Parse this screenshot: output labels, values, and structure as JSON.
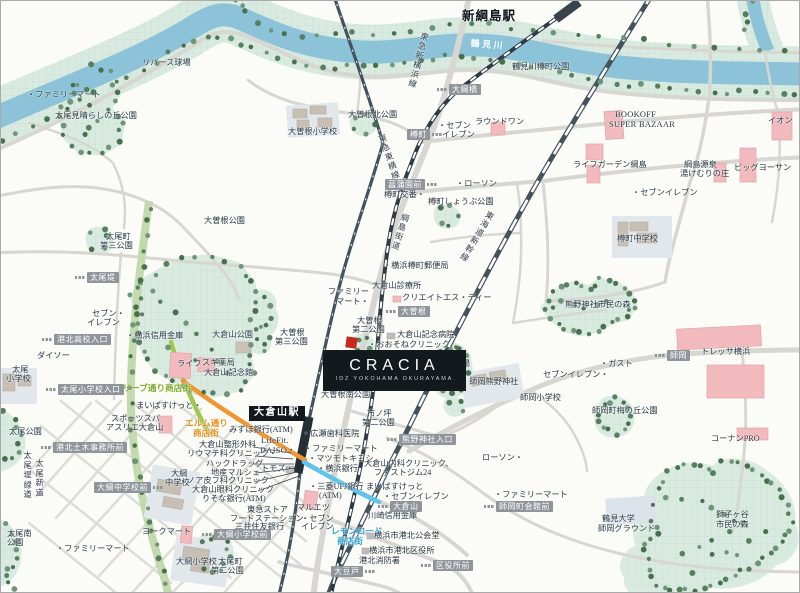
{
  "property": {
    "name": "CRACIA",
    "subtitle": "IDZ YOKOHAMA OKURAYAMA"
  },
  "map": {
    "river_name": "鶴見川",
    "colors": {
      "river": "#8cc3d8",
      "park": "#d9ebe1",
      "road": "#d7d6d1",
      "rail": "#44525c",
      "pink_building": "#f2babd",
      "badge": "#8f959a",
      "olive_street": "#9fc84e",
      "elm_street": "#f0962e",
      "lemon_street": "#5fc4ec",
      "site_marker": "#c8281f"
    },
    "labels": [
      {
        "t": "リバース球場",
        "x": 141,
        "y": 58
      },
      {
        "t": "・ファミリーマート",
        "x": 26,
        "y": 90
      },
      {
        "t": "太尾見晴らしの丘公園",
        "x": 54,
        "y": 111
      },
      {
        "t": "鶴見川",
        "x": 470,
        "y": 38,
        "c": "w",
        "r": 5
      },
      {
        "t": "鶴見川樽町公園",
        "x": 511,
        "y": 62
      },
      {
        "t": "新綱島駅",
        "x": 461,
        "y": 9,
        "c": "st"
      },
      {
        "t": "大曽根北公園",
        "x": 347,
        "y": 110
      },
      {
        "t": "大曽根小学校",
        "x": 287,
        "y": 127
      },
      {
        "t": "・セブン",
        "x": 437,
        "y": 121
      },
      {
        "t": "イレブン",
        "x": 441,
        "y": 130
      },
      {
        "t": "ラウンドワン",
        "x": 474,
        "y": 117
      },
      {
        "t": "BOOKOFF",
        "x": 614,
        "y": 110,
        "c": "en"
      },
      {
        "t": "SUPER BAZAAR",
        "x": 608,
        "y": 120,
        "c": "en"
      },
      {
        "t": "イオン",
        "x": 767,
        "y": 116
      },
      {
        "t": "ライフガーデン綱島",
        "x": 572,
        "y": 160
      },
      {
        "t": "綱島源泉",
        "x": 683,
        "y": 160
      },
      {
        "t": "湯けむりの庄",
        "x": 679,
        "y": 169
      },
      {
        "t": "ビッグヨーサン",
        "x": 733,
        "y": 163
      },
      {
        "t": "・セブンイレブン",
        "x": 631,
        "y": 188
      },
      {
        "t": "・ローソン",
        "x": 455,
        "y": 179
      },
      {
        "t": "樽町交番・",
        "x": 383,
        "y": 190
      },
      {
        "t": "樽町しょうぶ公園",
        "x": 427,
        "y": 197
      },
      {
        "t": "綱島街道",
        "x": 400,
        "y": 211,
        "c": "v",
        "r": 18
      },
      {
        "t": "東急新横浜線",
        "x": 419,
        "y": 30,
        "c": "v",
        "r": 14
      },
      {
        "t": "東急東横線",
        "x": 375,
        "y": 135,
        "c": "v",
        "r": -19
      },
      {
        "t": "東海道新幹線",
        "x": 486,
        "y": 208,
        "c": "v",
        "r": 31
      },
      {
        "t": "・横浜樽町郵便局",
        "x": 382,
        "y": 261
      },
      {
        "t": "大倉山診療所",
        "x": 371,
        "y": 281
      },
      {
        "t": "クリエイトエス・ディー",
        "x": 401,
        "y": 293
      },
      {
        "t": "ファミリー",
        "x": 327,
        "y": 287
      },
      {
        "t": "マート・",
        "x": 335,
        "y": 297
      },
      {
        "t": "大曽根",
        "x": 279,
        "y": 328
      },
      {
        "t": "第三公園",
        "x": 274,
        "y": 337
      },
      {
        "t": "大曽根",
        "x": 356,
        "y": 316
      },
      {
        "t": "第二公園",
        "x": 351,
        "y": 325
      },
      {
        "t": "大倉山記念病院",
        "x": 396,
        "y": 330
      },
      {
        "t": "・おおそねクリニック",
        "x": 367,
        "y": 340
      },
      {
        "t": "権現山広場",
        "x": 428,
        "y": 359
      },
      {
        "t": "・師岡熊野神社",
        "x": 460,
        "y": 377
      },
      {
        "t": "大曽根南公園",
        "x": 320,
        "y": 390
      },
      {
        "t": "師岡小学校",
        "x": 519,
        "y": 393
      },
      {
        "t": "・ガスト",
        "x": 599,
        "y": 359
      },
      {
        "t": "セブンイレブン・",
        "x": 542,
        "y": 370
      },
      {
        "t": "樽町中学校",
        "x": 616,
        "y": 234
      },
      {
        "t": "熊野神社市民の森",
        "x": 564,
        "y": 300
      },
      {
        "t": "トレッサ横浜",
        "x": 700,
        "y": 347
      },
      {
        "t": "師岡町梅の丘公園",
        "x": 591,
        "y": 406
      },
      {
        "t": "コーナンPRO",
        "x": 710,
        "y": 434
      },
      {
        "t": "鶴見大学",
        "x": 601,
        "y": 514
      },
      {
        "t": "師岡グラウンド",
        "x": 597,
        "y": 524
      },
      {
        "t": "獅子ヶ谷",
        "x": 715,
        "y": 510
      },
      {
        "t": "市民の森",
        "x": 715,
        "y": 520
      },
      {
        "t": "・ファミリーマート",
        "x": 493,
        "y": 490
      },
      {
        "t": "ローソン・",
        "x": 481,
        "y": 453
      },
      {
        "t": "みずほ銀行(ATM)",
        "x": 228,
        "y": 425
      },
      {
        "t": "・広瀬歯科医院",
        "x": 301,
        "y": 429
      },
      {
        "t": "LifeFit.",
        "x": 260,
        "y": 436,
        "c": "en"
      },
      {
        "t": "DAISO・",
        "x": 259,
        "y": 446,
        "c": "en"
      },
      {
        "t": "・ファミリーマート",
        "x": 303,
        "y": 444
      },
      {
        "t": "・マツモトキヨシ",
        "x": 307,
        "y": 454
      },
      {
        "t": "・横浜銀行",
        "x": 316,
        "y": 464
      },
      {
        "t": "トモズ・",
        "x": 260,
        "y": 464
      },
      {
        "t": "大倉山整形外科",
        "x": 198,
        "y": 440
      },
      {
        "t": "リウマチ科クリニック・",
        "x": 186,
        "y": 449
      },
      {
        "t": "ハックドラッグ",
        "x": 205,
        "y": 459
      },
      {
        "t": "地産マルシェ",
        "x": 210,
        "y": 468
      },
      {
        "t": "ノア皮フ科クリニック",
        "x": 186,
        "y": 476
      },
      {
        "t": "大倉山眼科クリニック",
        "x": 191,
        "y": 485
      },
      {
        "t": "りそな銀行(ATM)",
        "x": 201,
        "y": 494
      },
      {
        "t": "東急ストア",
        "x": 246,
        "y": 505
      },
      {
        "t": "フードステーション",
        "x": 229,
        "y": 514
      },
      {
        "t": "三井住友銀行",
        "x": 234,
        "y": 522
      },
      {
        "t": "(ATM)",
        "x": 246,
        "y": 531
      },
      {
        "t": "・三菱UFJ銀行",
        "x": 308,
        "y": 482
      },
      {
        "t": "(ATM)",
        "x": 318,
        "y": 491
      },
      {
        "t": "マルエツ",
        "x": 296,
        "y": 503
      },
      {
        "t": "・セブン",
        "x": 300,
        "y": 514
      },
      {
        "t": "イレブン",
        "x": 300,
        "y": 522
      },
      {
        "t": "ヨークマート",
        "x": 141,
        "y": 527
      },
      {
        "t": "・ファミリーマート",
        "x": 55,
        "y": 544
      },
      {
        "t": "大綱",
        "x": 170,
        "y": 469
      },
      {
        "t": "中学校",
        "x": 164,
        "y": 478
      },
      {
        "t": "大綱小学校",
        "x": 175,
        "y": 557
      },
      {
        "t": "太尾町",
        "x": 217,
        "y": 557
      },
      {
        "t": "第二公園",
        "x": 210,
        "y": 566
      },
      {
        "t": "太尾南",
        "x": 6,
        "y": 529
      },
      {
        "t": "公園",
        "x": 6,
        "y": 538
      },
      {
        "t": "太尾公園",
        "x": 8,
        "y": 427
      },
      {
        "t": "太尾",
        "x": 11,
        "y": 365
      },
      {
        "t": "小学校",
        "x": 5,
        "y": 374
      },
      {
        "t": "太尾堤緑道",
        "x": 21,
        "y": 450,
        "c": "v"
      },
      {
        "t": "太尾新道",
        "x": 33,
        "y": 458,
        "c": "v"
      },
      {
        "t": "まいばすけっと・",
        "x": 135,
        "y": 401
      },
      {
        "t": "スポーツスパ",
        "x": 110,
        "y": 414
      },
      {
        "t": "アスリエ大倉山",
        "x": 105,
        "y": 423
      },
      {
        "t": "エルム通り",
        "x": 184,
        "y": 418,
        "c": "o"
      },
      {
        "t": "商店街",
        "x": 192,
        "y": 428,
        "c": "o"
      },
      {
        "t": "オリーブ通り商店街",
        "x": 113,
        "y": 383,
        "c": "g"
      },
      {
        "t": "レモンロード",
        "x": 330,
        "y": 526,
        "c": "bl"
      },
      {
        "t": "商店街",
        "x": 336,
        "y": 536,
        "c": "bl"
      },
      {
        "t": "市ノ坪",
        "x": 366,
        "y": 409
      },
      {
        "t": "第二公園",
        "x": 361,
        "y": 418
      },
      {
        "t": "大倉山内科クリニック、",
        "x": 363,
        "y": 459
      },
      {
        "t": "ファストジム24",
        "x": 373,
        "y": 468
      },
      {
        "t": "まいばすけっと",
        "x": 365,
        "y": 482
      },
      {
        "t": "・セブンイレブン",
        "x": 382,
        "y": 492
      },
      {
        "t": "川崎信用金庫",
        "x": 367,
        "y": 511
      },
      {
        "t": "横浜市港北公会堂",
        "x": 373,
        "y": 531
      },
      {
        "t": "横浜市港北区役所",
        "x": 368,
        "y": 546
      },
      {
        "t": "港北消防署",
        "x": 358,
        "y": 556
      },
      {
        "t": "大倉山公園",
        "x": 211,
        "y": 330
      },
      {
        "t": "大倉山記念館",
        "x": 203,
        "y": 368
      },
      {
        "t": "・横浜信用金庫",
        "x": 125,
        "y": 331
      },
      {
        "t": "ライフ",
        "x": 176,
        "y": 359
      },
      {
        "t": "スギ薬局",
        "x": 201,
        "y": 358
      },
      {
        "t": "セブン・",
        "x": 91,
        "y": 309
      },
      {
        "t": "イレブン",
        "x": 86,
        "y": 318
      },
      {
        "t": "ダイソー",
        "x": 36,
        "y": 351
      },
      {
        "t": "太尾町",
        "x": 105,
        "y": 232
      },
      {
        "t": "第三公園",
        "x": 99,
        "y": 241
      },
      {
        "t": "大曽根公園",
        "x": 203,
        "y": 216
      },
      {
        "t": "大倉山駅",
        "x": 248,
        "y": 405,
        "c": "stb"
      }
    ],
    "bus_stops": [
      {
        "t": "大綱橋",
        "x": 436,
        "y": 83,
        "i": "l"
      },
      {
        "t": "樽町",
        "x": 406,
        "y": 128,
        "i": "r"
      },
      {
        "t": "菖蒲園前",
        "x": 384,
        "y": 178,
        "i": "r"
      },
      {
        "t": "太尾堤",
        "x": 74,
        "y": 271,
        "i": "l"
      },
      {
        "t": "港北高校入口",
        "x": 41,
        "y": 333,
        "i": "l"
      },
      {
        "t": "太尾小学校入口",
        "x": 45,
        "y": 383,
        "i": "l"
      },
      {
        "t": "港北土木事務所前",
        "x": 40,
        "y": 441,
        "i": "l"
      },
      {
        "t": "大綱中学校前",
        "x": 93,
        "y": 481,
        "i": "r"
      },
      {
        "t": "大綱小学校前",
        "x": 201,
        "y": 528,
        "i": "l"
      },
      {
        "t": "大曽根",
        "x": 385,
        "y": 305,
        "i": "l"
      },
      {
        "t": "熊野神社入口",
        "x": 386,
        "y": 433,
        "i": "l"
      },
      {
        "t": "大倉山",
        "x": 377,
        "y": 500,
        "i": "l"
      },
      {
        "t": "師岡町会館前",
        "x": 483,
        "y": 500,
        "i": "l"
      },
      {
        "t": "区役所前",
        "x": 420,
        "y": 559,
        "i": "l"
      },
      {
        "t": "大豆戸",
        "x": 330,
        "y": 565,
        "i": "r"
      },
      {
        "t": "師岡",
        "x": 654,
        "y": 349,
        "i": "l"
      }
    ]
  }
}
